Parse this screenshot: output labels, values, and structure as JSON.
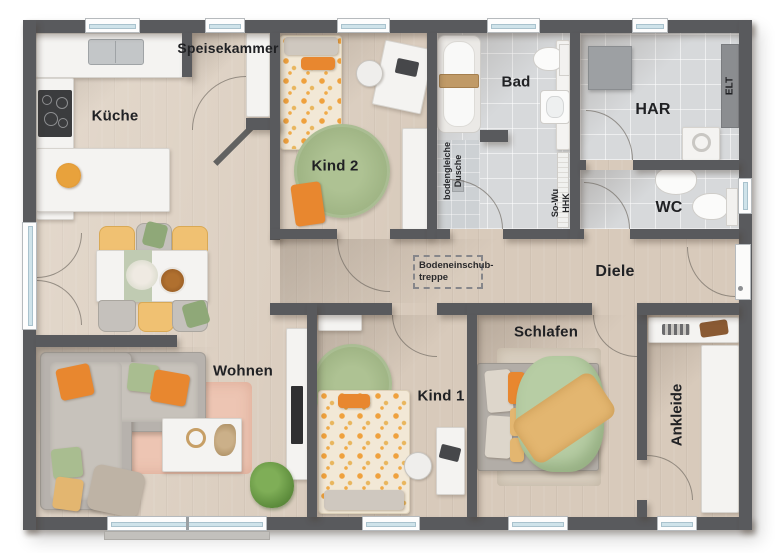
{
  "labels": {
    "kueche": "Küche",
    "speisekammer": "Speisekammer",
    "kind2": "Kind 2",
    "bad": "Bad",
    "har": "HAR",
    "wc": "WC",
    "diele": "Diele",
    "wohnen": "Wohnen",
    "kind1": "Kind 1",
    "schlafen": "Schlafen",
    "ankleide": "Ankleide"
  },
  "annotations": {
    "shower_line1": "bodengleiche",
    "shower_line2": "Dusche",
    "heater_line1": "So-Wu",
    "heater_line2": "HHK",
    "elt": "ELT",
    "attic_line1": "Bodeneinschub-",
    "attic_line2": "treppe"
  },
  "colors": {
    "wall": "#595a5d",
    "wood_floor": "#d8cabb",
    "tile_floor": "#d7d9db",
    "furniture_white": "#f4f3f1",
    "accent_orange": "#e8872f",
    "rug_pink": "#edc5b3",
    "rug_green": "#a5ba8d",
    "duvet_green": "#b7cda4",
    "blanket_yellow": "#e3b670"
  }
}
